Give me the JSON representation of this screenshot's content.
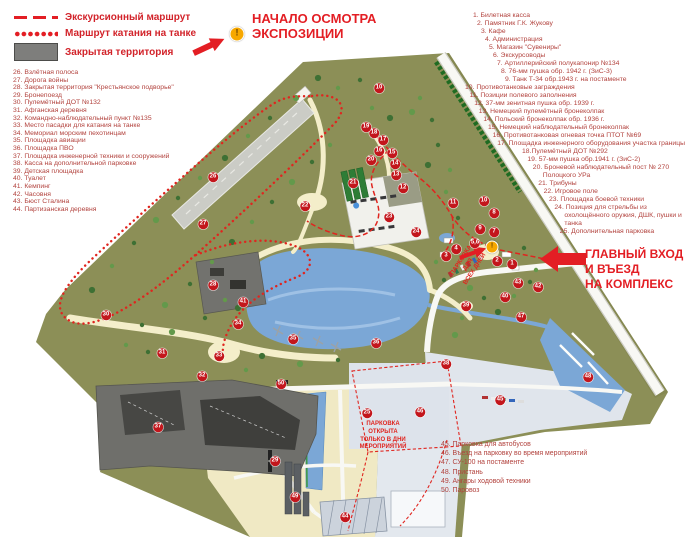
{
  "legend": {
    "items": [
      {
        "key": "excursion-route",
        "label": "Экскурсионный маршрут"
      },
      {
        "key": "tank-ride-route",
        "label": "Маршрут катания на танке"
      },
      {
        "key": "closed-territory",
        "label": "Закрытая территория"
      }
    ]
  },
  "callouts": {
    "start_viewing": "НАЧАЛО ОСМОТРА\nЭКСПОЗИЦИИ",
    "main_entrance": "ГЛАВНЫЙ ВХОД\nИ ВЪЕЗД\nНА КОМПЛЕКС",
    "parking_all_days": "ПАРКОВКА\nДЛЯ\nВСЕХ ДНЕЙ",
    "parking_events_only": "ПАРКОВКА\nОТКРЫТА\nТОЛЬКО В ДНИ\nМЕРОПРИЯТИЙ"
  },
  "lists": {
    "right": [
      "1. Билетная касса",
      "2. Памятник Г.К. Жукову",
      "3. Кафе",
      "4. Администрация",
      "5. Магазин \"Сувениры\"",
      "6. Экскурсоводы",
      "7. Артиллерийский полукапонир №134",
      "8. 76-мм пушка обр. 1942 г. (ЗиС-3)",
      "9. Танк Т-34 обр.1943 г. на постаменте",
      "10. Противотанковые заграждения",
      "11. Позиции полевого заполнения",
      "12. 37-мм зенитная пушка обр. 1939 г.",
      "13. Немецкий пулемётный бронеколпак",
      "14. Польский бронеколпак обр. 1936 г.",
      "15. Немецкий наблюдательный бронеколпак",
      "16. Противотанковая огневая точка ПТОТ №69",
      "17. Площадка инженерного оборудования участка границы",
      "18.Пулемётный ДОТ №292",
      "19. 57-мм пушка обр.1941 г. (ЗиС-2)",
      "20. Броневой наблюдательный пост № 270 Полоцкого УРа",
      "21. Трибуны",
      "22. Игровое поле",
      "23. Площадка боевой техники",
      "24. Позиция для стрельбы из охолощённого оружия, ДШК, пушки и танка",
      "25. Дополнительная парковка"
    ],
    "left": [
      "26. Взлётная полоса",
      "27. Дорога войны",
      "28. Закрытая территория \"Крестьянское подворье\"",
      "29. Бронепоезд",
      "30. Пулемётный ДОТ №132",
      "31. Афганская деревня",
      "32. Командно-наблюдательный пункт №135",
      "33. Место пасадки для катания на танке",
      "34. Мемориал морским пехотинцам",
      "35. Площадка авиации",
      "36. Площадка ПВО",
      "37. Площадка инженерной техники и сооружений",
      "38. Касса на дополнительной парковке",
      "39. Детская площадка",
      "40. Туалет",
      "41. Кемпинг",
      "42. Часовня",
      "43. Бюст Сталина",
      "44. Партизанская деревня"
    ],
    "bottom": [
      "45. Парковка для автобусов",
      "46. Въезд на парковку во время мероприятий",
      "47. СУ-100 на постаменте",
      "48. Пристань",
      "49. Ангары ходовой техники",
      "50. Паровоз"
    ]
  },
  "map": {
    "markers": [
      {
        "n": "1",
        "x": 512,
        "y": 264
      },
      {
        "n": "2",
        "x": 497,
        "y": 261
      },
      {
        "n": "3",
        "x": 446,
        "y": 256
      },
      {
        "n": "4",
        "x": 456,
        "y": 249
      },
      {
        "n": "5,6",
        "x": 475,
        "y": 243
      },
      {
        "n": "7",
        "x": 494,
        "y": 232
      },
      {
        "n": "8",
        "x": 494,
        "y": 213
      },
      {
        "n": "9",
        "x": 480,
        "y": 229
      },
      {
        "n": "10",
        "x": 484,
        "y": 201
      },
      {
        "n": "10",
        "x": 379,
        "y": 88
      },
      {
        "n": "11",
        "x": 453,
        "y": 203
      },
      {
        "n": "12",
        "x": 403,
        "y": 188
      },
      {
        "n": "13",
        "x": 396,
        "y": 175
      },
      {
        "n": "14",
        "x": 395,
        "y": 164
      },
      {
        "n": "15",
        "x": 392,
        "y": 153
      },
      {
        "n": "16",
        "x": 379,
        "y": 151
      },
      {
        "n": "17",
        "x": 383,
        "y": 140
      },
      {
        "n": "18",
        "x": 374,
        "y": 133
      },
      {
        "n": "19",
        "x": 366,
        "y": 127
      },
      {
        "n": "20",
        "x": 371,
        "y": 160
      },
      {
        "n": "21",
        "x": 353,
        "y": 183
      },
      {
        "n": "22",
        "x": 305,
        "y": 206
      },
      {
        "n": "23",
        "x": 389,
        "y": 217
      },
      {
        "n": "24",
        "x": 416,
        "y": 232
      },
      {
        "n": "25",
        "x": 367,
        "y": 413
      },
      {
        "n": "26",
        "x": 213,
        "y": 177
      },
      {
        "n": "27",
        "x": 203,
        "y": 224
      },
      {
        "n": "28",
        "x": 213,
        "y": 285
      },
      {
        "n": "29",
        "x": 275,
        "y": 461
      },
      {
        "n": "30",
        "x": 106,
        "y": 315
      },
      {
        "n": "31",
        "x": 162,
        "y": 353
      },
      {
        "n": "32",
        "x": 202,
        "y": 376
      },
      {
        "n": "33",
        "x": 219,
        "y": 356
      },
      {
        "n": "34",
        "x": 238,
        "y": 324
      },
      {
        "n": "35",
        "x": 293,
        "y": 339
      },
      {
        "n": "36",
        "x": 376,
        "y": 343
      },
      {
        "n": "37",
        "x": 158,
        "y": 427
      },
      {
        "n": "38",
        "x": 446,
        "y": 364
      },
      {
        "n": "39",
        "x": 466,
        "y": 306
      },
      {
        "n": "40",
        "x": 505,
        "y": 297
      },
      {
        "n": "41",
        "x": 243,
        "y": 302
      },
      {
        "n": "42",
        "x": 538,
        "y": 287
      },
      {
        "n": "43",
        "x": 518,
        "y": 283
      },
      {
        "n": "44",
        "x": 345,
        "y": 517
      },
      {
        "n": "45",
        "x": 500,
        "y": 400
      },
      {
        "n": "46",
        "x": 420,
        "y": 412
      },
      {
        "n": "47",
        "x": 521,
        "y": 317
      },
      {
        "n": "48",
        "x": 588,
        "y": 377
      },
      {
        "n": "49",
        "x": 295,
        "y": 497
      },
      {
        "n": "50",
        "x": 281,
        "y": 384
      }
    ],
    "warning_icons": [
      {
        "x": 237,
        "y": 34,
        "size": 13
      },
      {
        "x": 492,
        "y": 247,
        "size": 11
      }
    ],
    "colors": {
      "accent_red": "#e31e24",
      "list_red": "#b2423d",
      "marker_red": "#c3161c",
      "terrain_olive": "#8c8f57",
      "water_blue": "#7ba7d6",
      "path_cream": "#f4eeca",
      "closed_gray": "#6f6f6b",
      "parking_gray": "#e0e5ec",
      "warning_orange": "#f7a800",
      "tree_green": "#3e7034"
    }
  }
}
